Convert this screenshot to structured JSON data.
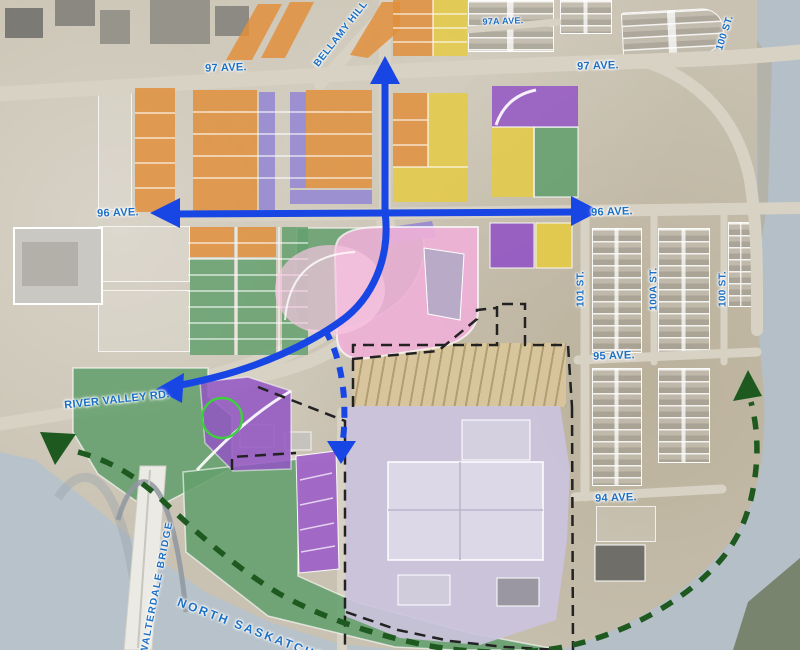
{
  "map": {
    "description": "Aerial land-use concept map of Rossdale / river crossing area with colored zoning overlays, blue road arrows and dashed trail lines"
  },
  "labels": [
    {
      "id": "ave-97-west",
      "text": "97 AVE."
    },
    {
      "id": "ave-97-east",
      "text": "97 AVE."
    },
    {
      "id": "ave-97a",
      "text": "97A AVE."
    },
    {
      "id": "bellamy-hill",
      "text": "BELLAMY HILL"
    },
    {
      "id": "ave-96-west",
      "text": "96 AVE."
    },
    {
      "id": "ave-96-east",
      "text": "96 AVE."
    },
    {
      "id": "ave-95",
      "text": "95 AVE."
    },
    {
      "id": "ave-94",
      "text": "94 AVE."
    },
    {
      "id": "st-101",
      "text": "101 ST."
    },
    {
      "id": "st-100a",
      "text": "100A ST."
    },
    {
      "id": "st-100-east",
      "text": "100 ST."
    },
    {
      "id": "st-100-north",
      "text": "100 ST."
    },
    {
      "id": "river-valley-rd",
      "text": "RIVER VALLEY RD."
    },
    {
      "id": "walterdale-bridge",
      "text": "WALTERDALE BRIDGE"
    },
    {
      "id": "north-saskatchewan",
      "text": "NORTH SASKATCHEWAN"
    }
  ],
  "colors": {
    "arrow_blue": "#1846e4",
    "trail_green": "#1e5a1f",
    "label_blue": "#1b6fc4",
    "boundary_black": "#222222",
    "zone_orange": "#e08f3c",
    "zone_purple": "#9356c4",
    "zone_periwinkle": "#968ad2",
    "zone_yellow": "#e5ca45",
    "zone_green": "#64a06e",
    "zone_pink": "#f0b1d8",
    "zone_lavender": "#cbc3dd",
    "hatch_tan": "#d9c69b",
    "river": "#b5bfc7",
    "land": "#c9c2b2",
    "highlight_circle": "#3ecf3e"
  },
  "zones": [
    {
      "name": "orange-lowrise-parcels",
      "color": "#e08f3c"
    },
    {
      "name": "purple-rowhouse-parcels",
      "color": "#968ad2"
    },
    {
      "name": "purple-mixed-parcels",
      "color": "#9356c4"
    },
    {
      "name": "yellow-parcels",
      "color": "#e5ca45"
    },
    {
      "name": "green-open-space",
      "color": "#64a06e"
    },
    {
      "name": "pink-ballpark",
      "color": "#f0b1d8"
    },
    {
      "name": "lavender-power-plant-site",
      "color": "#cbc3dd"
    },
    {
      "name": "hatched-transition-area",
      "color": "#d9c69b"
    }
  ]
}
